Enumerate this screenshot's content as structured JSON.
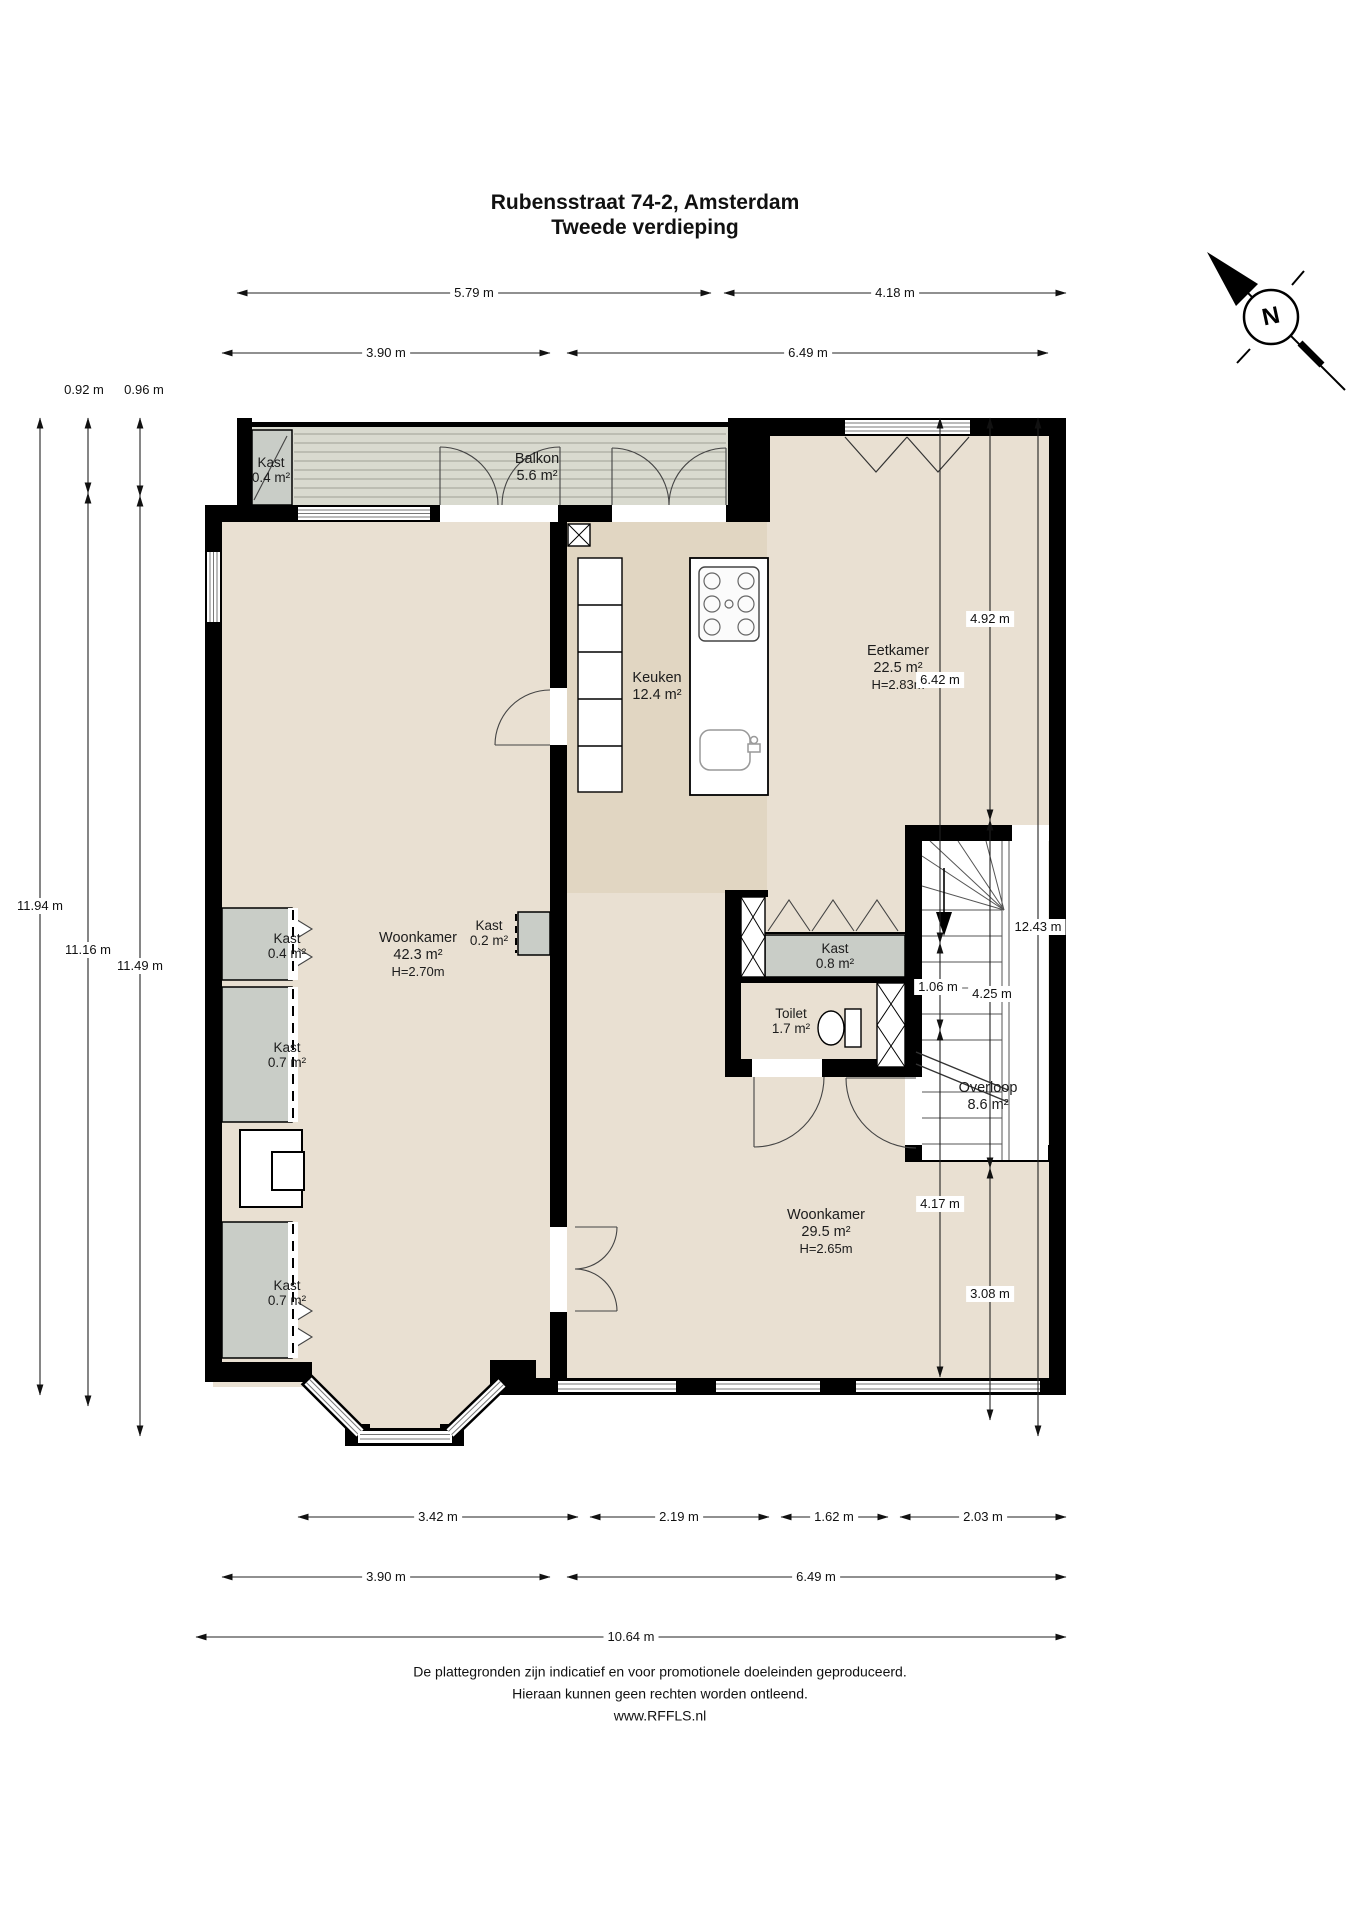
{
  "title": {
    "line1": "Rubensstraat 74-2, Amsterdam",
    "line2": "Tweede verdieping"
  },
  "compass": {
    "letter": "N"
  },
  "rooms": {
    "kast_balkon": {
      "name": "Kast",
      "area": "0.4 m²"
    },
    "balkon": {
      "name": "Balkon",
      "area": "5.6 m²"
    },
    "keuken": {
      "name": "Keuken",
      "area": "12.4 m²"
    },
    "eetkamer": {
      "name": "Eetkamer",
      "area": "22.5 m²",
      "height": "H=2.83m"
    },
    "woonkamer_voor": {
      "name": "Woonkamer",
      "area": "42.3 m²",
      "height": "H=2.70m"
    },
    "kast_links_boven": {
      "name": "Kast",
      "area": "0.4 m²"
    },
    "kast_links_midden": {
      "name": "Kast",
      "area": "0.7 m²"
    },
    "kast_links_onder": {
      "name": "Kast",
      "area": "0.7 m²"
    },
    "kast_klein": {
      "name": "Kast",
      "area": "0.2 m²"
    },
    "kast_hal": {
      "name": "Kast",
      "area": "0.8 m²"
    },
    "toilet": {
      "name": "Toilet",
      "area": "1.7 m²"
    },
    "overloop": {
      "name": "Overloop",
      "area": "8.6 m²"
    },
    "woonkamer_achter": {
      "name": "Woonkamer",
      "area": "29.5 m²",
      "height": "H=2.65m"
    }
  },
  "dimensions": {
    "top": {
      "d1": "5.79 m",
      "d2": "4.18 m",
      "d3": "3.90 m",
      "d4": "6.49 m"
    },
    "left": {
      "d1": "0.92 m",
      "d2": "0.96 m",
      "d3": "11.16 m",
      "d4": "11.49 m",
      "d5": "11.94 m"
    },
    "right": {
      "d1": "4.92 m",
      "d2": "6.42 m",
      "d3": "12.43 m",
      "d4": "4.25 m",
      "d5": "1.06 m",
      "d6": "4.17 m",
      "d7": "3.08 m"
    },
    "bottom": {
      "d1": "3.42 m",
      "d2": "2.19 m",
      "d3": "1.62 m",
      "d4": "2.03 m",
      "d5": "3.90 m",
      "d6": "6.49 m",
      "d7": "10.64 m"
    }
  },
  "footer": {
    "line1": "De plattegronden zijn indicatief en voor promotionele doeleinden geproduceerd.",
    "line2": "Hieraan kunnen geen rechten worden ontleend.",
    "line3": "www.RFFLS.nl"
  },
  "colors": {
    "wall": "#000000",
    "floor": "#e9e0d2",
    "kitchen_floor": "#e1d6c2",
    "closet": "#c9cdc7",
    "balcony": "#d9dacf",
    "landing": "#edebe3"
  }
}
